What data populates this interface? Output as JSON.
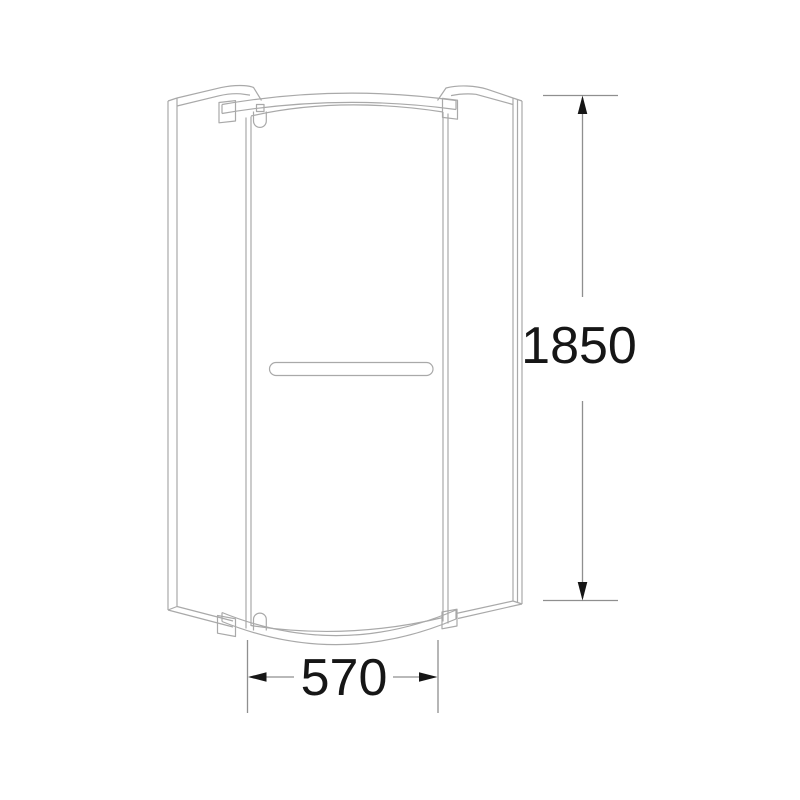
{
  "drawing": {
    "subject": "quadrant shower enclosure front elevation",
    "style": "technical line drawing"
  },
  "dimensions": {
    "height": {
      "value": "1850",
      "orientation": "vertical"
    },
    "width": {
      "value": "570",
      "orientation": "horizontal"
    }
  },
  "colors": {
    "background": "#ffffff",
    "drawing_line": "#a9a9a9",
    "dimension_line": "#8f8f8f",
    "dimension_text": "#161616"
  }
}
